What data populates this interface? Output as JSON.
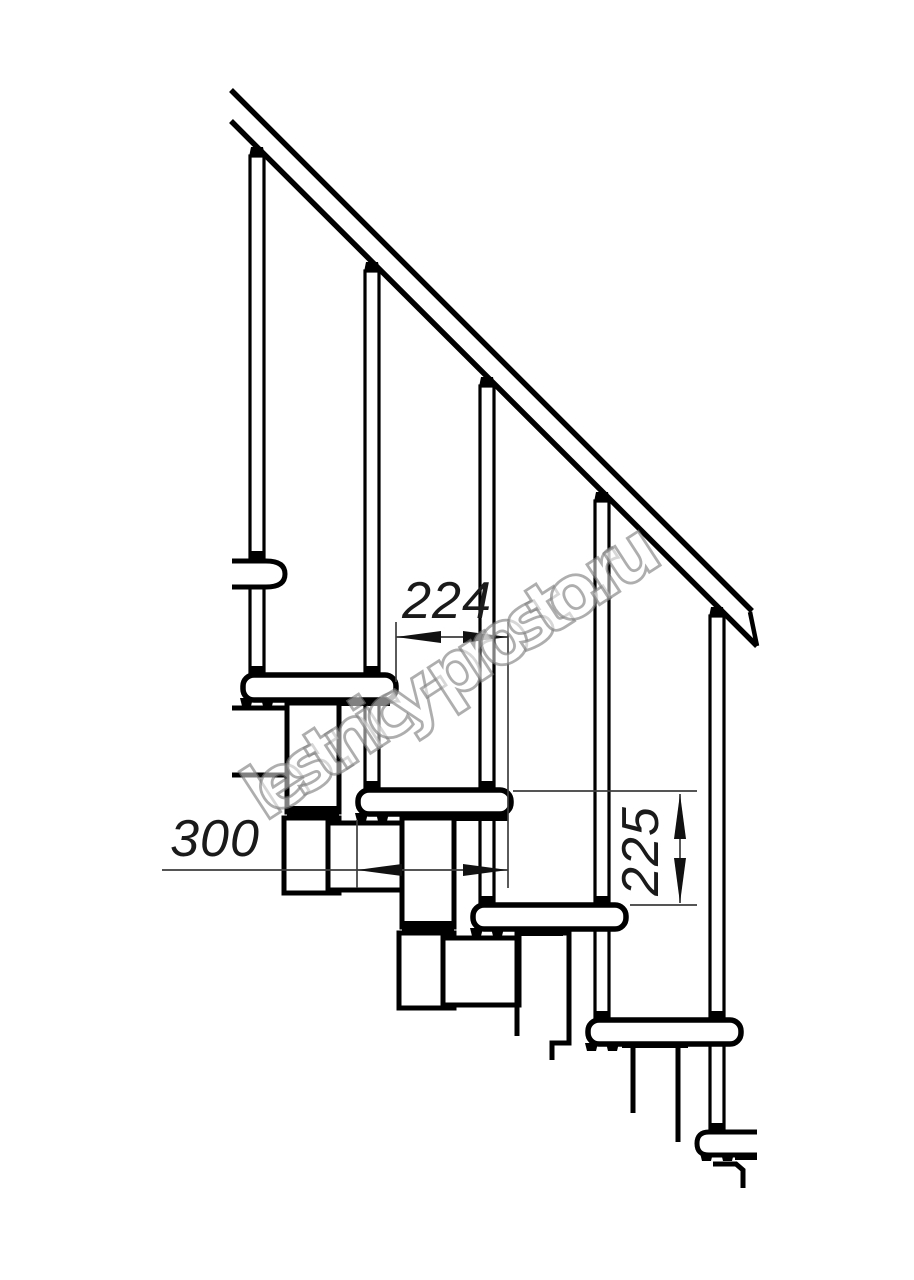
{
  "drawing": {
    "type": "staircase-side-view-technical-drawing",
    "watermark": "lestnicy-prosto.ru",
    "dimensions": {
      "step_run": "224",
      "tread_depth": "300",
      "step_height": "225"
    },
    "colors": {
      "outline": "#000000",
      "dimension_line": "#3d3d3d",
      "dimension_text": "#1a1a1a",
      "watermark_outline": "#7d7d7d",
      "background": "#ffffff"
    }
  }
}
